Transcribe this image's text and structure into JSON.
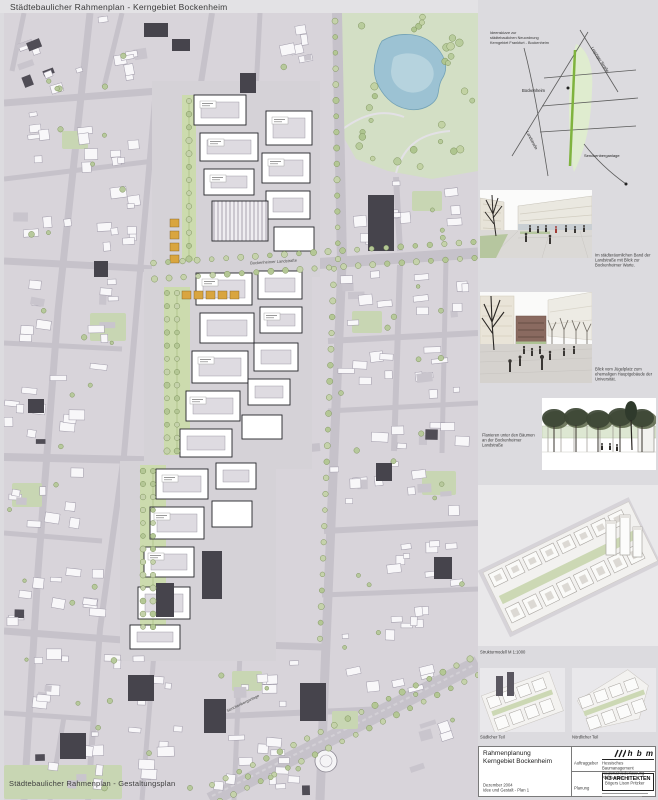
{
  "poster": {
    "title_left": "Städtebaulicher Rahmenplan - Kerngebiet Bockenheim",
    "title_right": "Idee und Gestalt - Plan 1",
    "map_overlay_caption": "Städtebaulicher Rahmenplan - Gestaltungsplan"
  },
  "map": {
    "street_labels": [
      {
        "id": "bockenheimer-landstrasse",
        "text": "Bockenheimer Landstraße"
      },
      {
        "id": "senckenberganlage",
        "text": "Senckenberganlage"
      }
    ]
  },
  "locator": {
    "note_lines": [
      "Ideenskizze zur",
      "städtebaulichen Neuordnung",
      "Kerngebiet Frankfurt - Bockenheim"
    ],
    "labels": {
      "bockenheim": "Bockenheim",
      "leipziger": "Leipziger Straße",
      "landstrasse": "Landstraße",
      "senckenberganlage": "Senckenberganlage"
    }
  },
  "sidebar": {
    "captions": {
      "view1": "Im städteräumlichen Band der Landstraße mit Blick zur Bockenheimer Warte.",
      "view2": "Blick vom Jügelplatz zum ehemaligen Hauptgebäude der Universität.",
      "view3": "Flanieren unter den Bäumen an der Bockenheimer Landstraße",
      "model": "Strukturmodell  M 1:1000",
      "mini_south": "Südlicher Teil",
      "mini_north": "Nördlicher Teil"
    }
  },
  "titleblock": {
    "project_line1": "Rahmenplanung",
    "project_line2": "Kerngebiet Bockenheim",
    "date": "Dezember 2004",
    "plan_name": "Idee und Gestalt - Plan 1",
    "client_label": "Auftraggeber",
    "planning_label": "Planung",
    "client_logo_text": "h b m",
    "client_name_line1": "Hessisches Baumanagement",
    "client_name_line2": "Regionalniederlassung Rhein-Main",
    "architect_name": "K3 ARCHITEKTEN",
    "architect_partners": "Bögers  Lison  Pritzker"
  },
  "colors": {
    "accent_green": "#7fb33e",
    "paper": "#dcdbdf",
    "street": "#c6c2ca",
    "block": "#d8d4da",
    "plan_white": "#ffffff",
    "green_area": "#ccdbae",
    "pond_blue": "#9cc2d3",
    "dark_building": "#46444c",
    "marker_orange": "#d9a53f"
  }
}
